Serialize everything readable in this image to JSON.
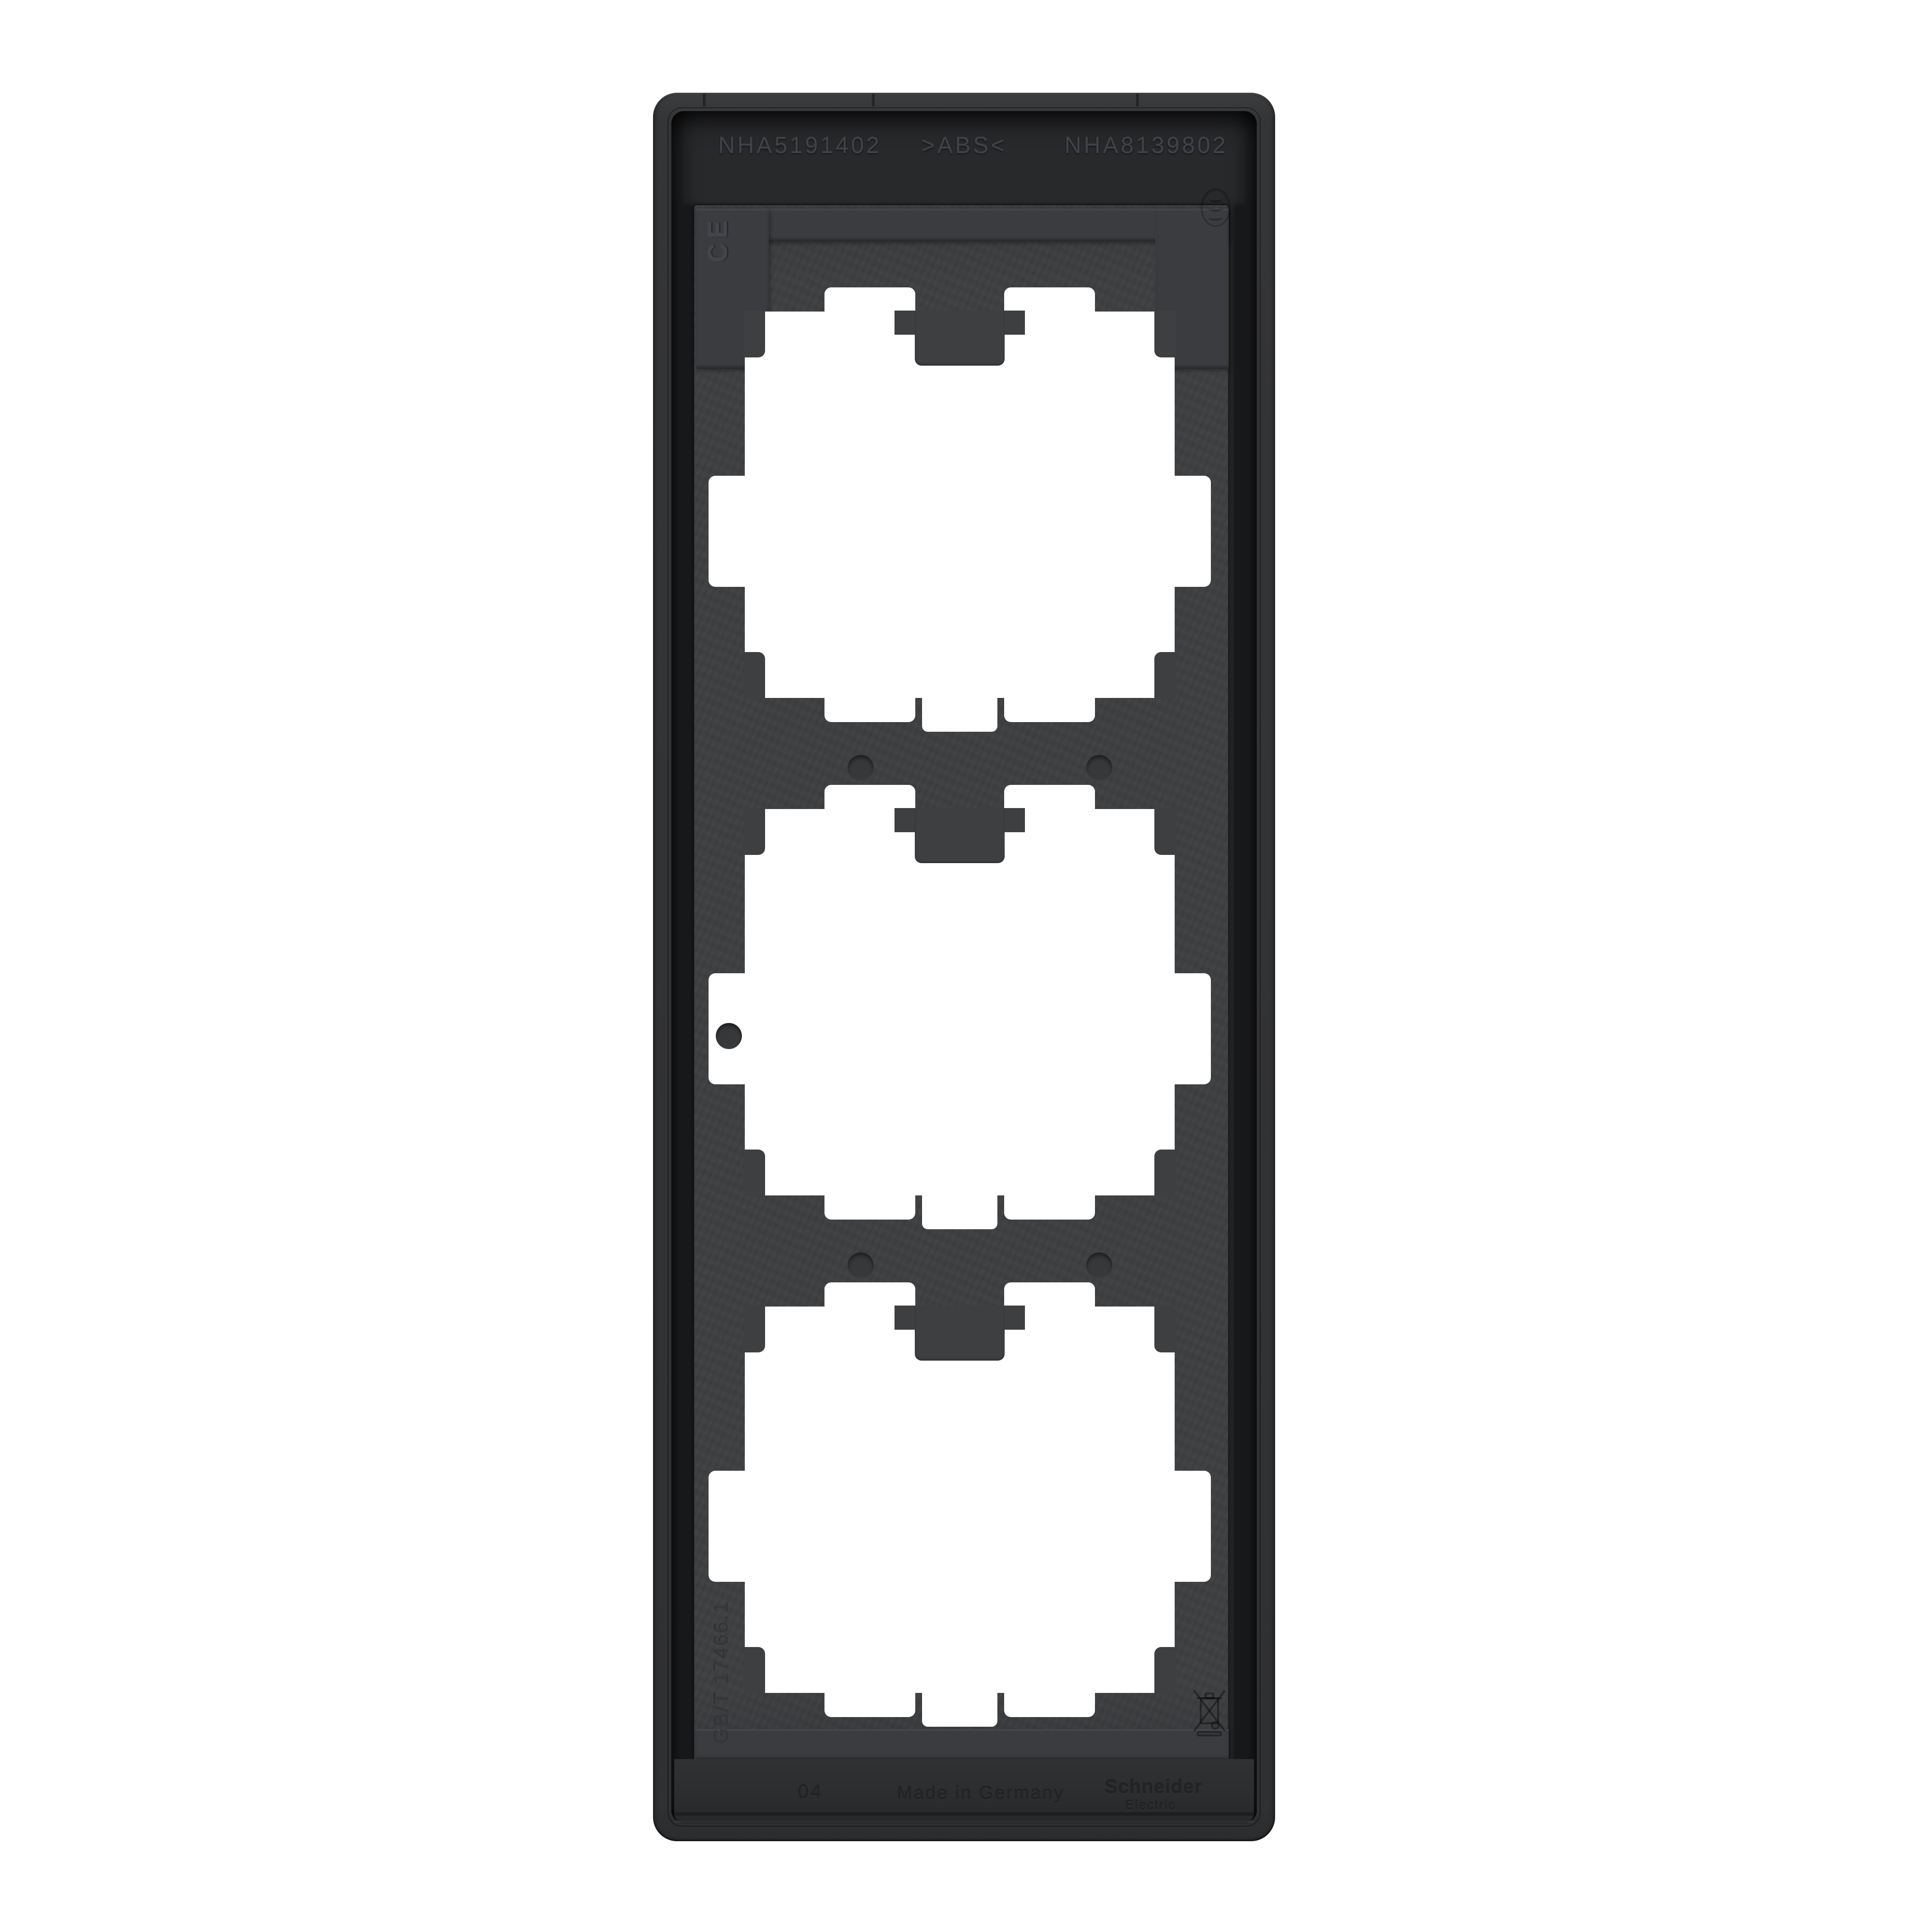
{
  "photo": {
    "subject": "Rear view of a 3-gang anthracite electrical cover frame",
    "background": "#ffffff"
  },
  "markings": {
    "code_left": "NHA5191402",
    "material": ">ABS<",
    "code_right": "NHA8139802",
    "ce": "CE",
    "standard": "GB/T 17466.1",
    "mold_stamp": "04",
    "origin": "Made in Germany",
    "brand_line1": "Schneider",
    "brand_line2": "Electric"
  },
  "icons": {
    "ce_mark": "ce-conformity-mark",
    "wavy_mark": "three-wavy-lines-material-mark",
    "weee_mark": "crossed-out-wheelie-bin"
  },
  "colors": {
    "background": "#ffffff",
    "frame_base": "#323335",
    "cavity": "#28292b",
    "plate": "#3e3f41",
    "ledge": "#3b3c3f",
    "rail": "#2c2d2e",
    "window": "#ffffff",
    "emboss_light": "#40424a",
    "emboss_dark": "#222325"
  }
}
